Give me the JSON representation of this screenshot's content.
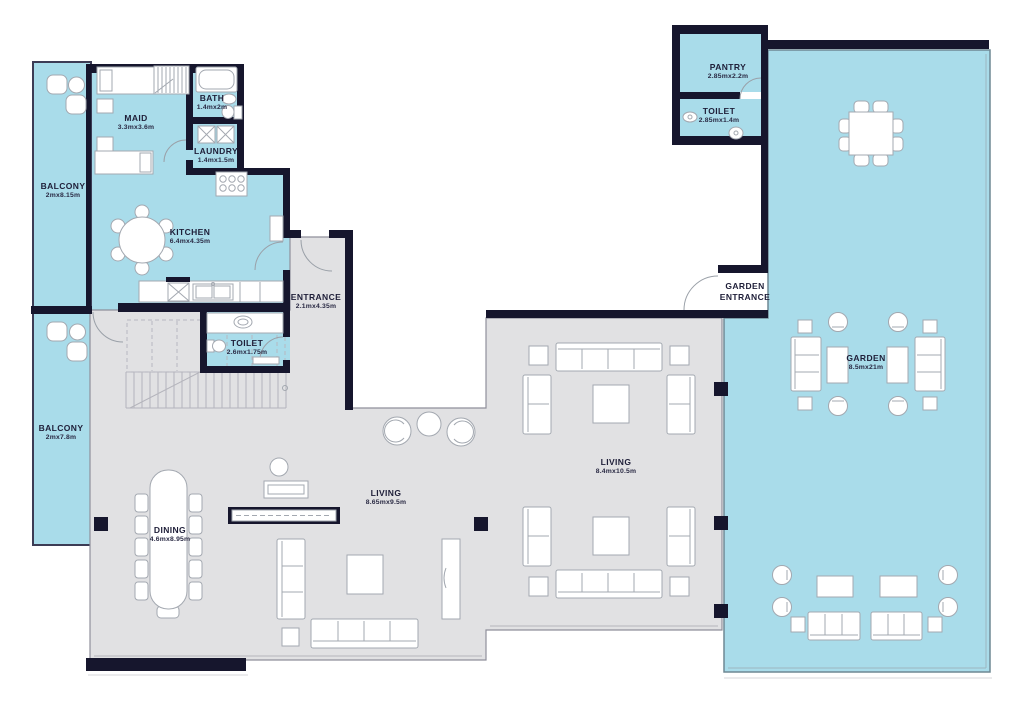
{
  "plan_title": "Apartment floor plan",
  "rooms": [
    {
      "id": "balcony-upper",
      "label": "BALCONY",
      "dims": "2mx8.15m"
    },
    {
      "id": "maid",
      "label": "MAID",
      "dims": "3.3mx3.6m"
    },
    {
      "id": "bath",
      "label": "BATH",
      "dims": "1.4mx2m"
    },
    {
      "id": "laundry",
      "label": "LAUNDRY",
      "dims": "1.4mx1.5m"
    },
    {
      "id": "kitchen",
      "label": "KITCHEN",
      "dims": "6.4mx4.35m"
    },
    {
      "id": "entrance",
      "label": "ENTRANCE",
      "dims": "2.1mx4.35m"
    },
    {
      "id": "toilet-main",
      "label": "TOILET",
      "dims": "2.6mx1.75m"
    },
    {
      "id": "balcony-lower",
      "label": "BALCONY",
      "dims": "2mx7.8m"
    },
    {
      "id": "dining",
      "label": "DINING",
      "dims": "4.6mx8.95m"
    },
    {
      "id": "living-left",
      "label": "LIVING",
      "dims": "8.65mx9.5m"
    },
    {
      "id": "living-right",
      "label": "LIVING",
      "dims": "8.4mx10.5m"
    },
    {
      "id": "pantry",
      "label": "PANTRY",
      "dims": "2.85mx2.2m"
    },
    {
      "id": "toilet-garden",
      "label": "TOILET",
      "dims": "2.85mx1.4m"
    },
    {
      "id": "garden-entrance",
      "label": "GARDEN ENTRANCE",
      "dims": ""
    },
    {
      "id": "garden",
      "label": "GARDEN",
      "dims": "8.5mx21m"
    }
  ],
  "colors": {
    "wet_area_floor": "#a9dcea",
    "living_floor": "#e1e1e3",
    "wall": "#16162d",
    "background": "#ffffff",
    "label_text": "#1e1e38"
  }
}
